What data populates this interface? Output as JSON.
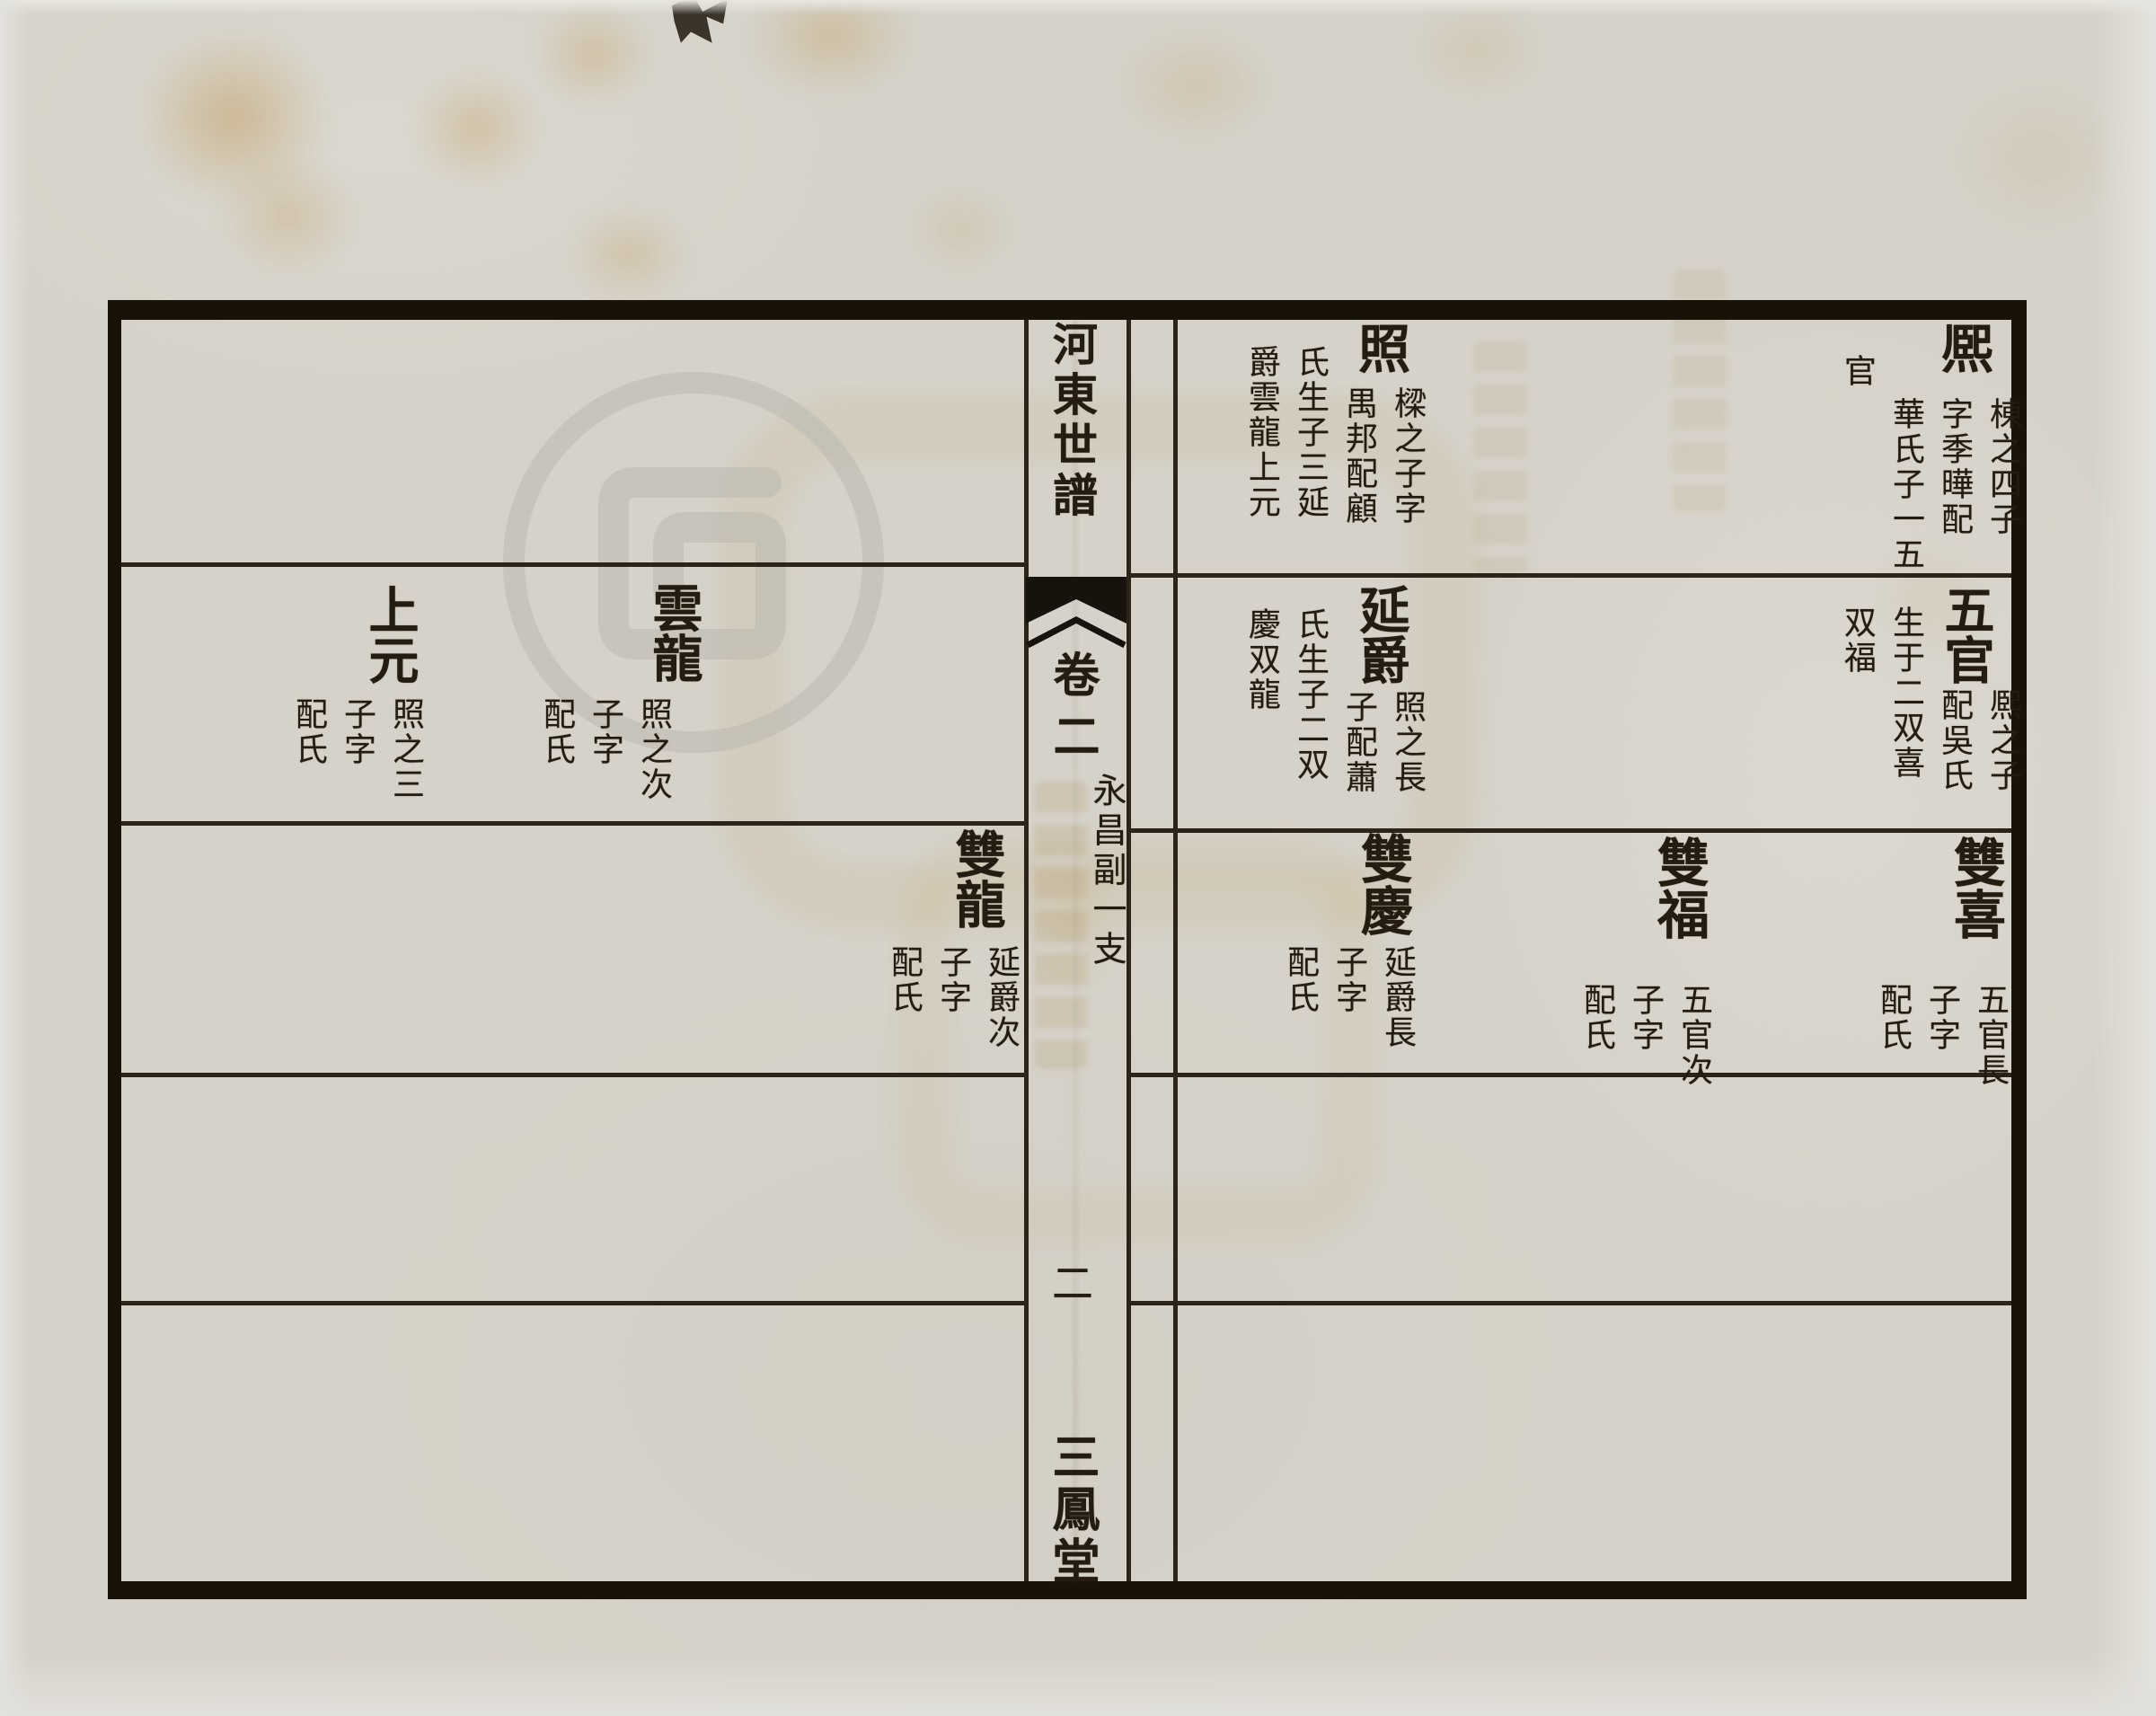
{
  "colors": {
    "paper": "#d6d2c9",
    "ink": "#241c10",
    "frame_border": "#181208",
    "stain": "#bc9654",
    "watermark_gray": "#b3b0a9"
  },
  "icons": {
    "fishtail": "yuwei-center-fold-marker",
    "watermark": "archive-watermark-spiral",
    "ink_smudge": "ink-smudge"
  },
  "center_column": {
    "title": "河東世譜",
    "volume": "卷二",
    "branch": "永昌副一支",
    "page_number": "二",
    "hall_name": "三鳳堂"
  },
  "right_page": {
    "entries": [
      {
        "name": "熈",
        "notes": [
          "棟之四子",
          "字季曄配",
          "華氏子一五",
          "官"
        ]
      },
      {
        "name": "照",
        "notes": [
          "樑之子字",
          "禺邦配顧",
          "氏生子三延",
          "爵雲龍上元"
        ]
      },
      {
        "name": "五官",
        "notes": [
          "熈之子",
          "配吳氏",
          "生于二双喜",
          "双福"
        ]
      },
      {
        "name": "延爵",
        "notes": [
          "照之長",
          "子配蕭",
          "氏生子二双",
          "慶双龍"
        ]
      },
      {
        "name": "雙喜",
        "notes": [
          "五官長",
          "子字",
          "配氏"
        ]
      },
      {
        "name": "雙福",
        "notes": [
          "五官次",
          "子字",
          "配氏"
        ]
      },
      {
        "name": "雙慶",
        "notes": [
          "延爵長",
          "子字",
          "配氏"
        ]
      }
    ]
  },
  "left_page": {
    "entries": [
      {
        "name": "雲龍",
        "notes": [
          "照之次",
          "子字",
          "配氏"
        ]
      },
      {
        "name": "上元",
        "notes": [
          "照之三",
          "子字",
          "配氏"
        ]
      },
      {
        "name": "雙龍",
        "notes": [
          "延爵次",
          "子字",
          "配氏"
        ]
      }
    ]
  }
}
